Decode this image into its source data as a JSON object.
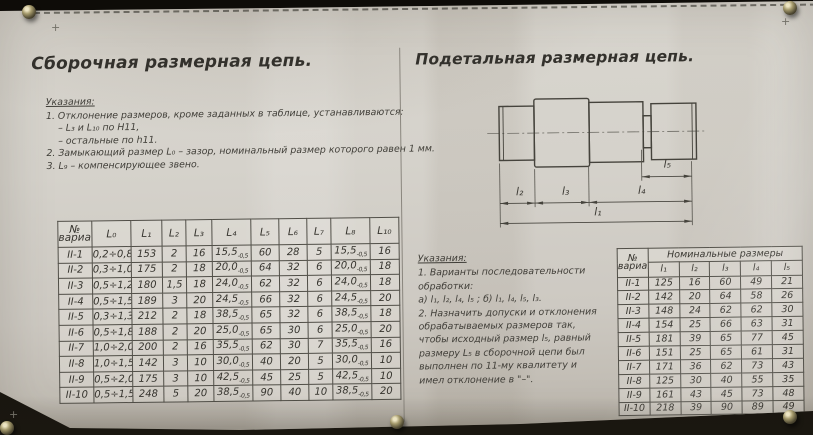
{
  "colors": {
    "paper": "#d6d2ca",
    "ink": "#3c3a35",
    "background": "#12100b",
    "table_line": "#504e47"
  },
  "left": {
    "title": "Сборочная размерная цепь.",
    "notes_heading": "Указания:",
    "notes": [
      "1. Отклонение размеров, кроме заданных в таблице, устанавливаются:",
      "    – L₃ и L₁₀ по H11,",
      "    – остальные по h11.",
      "2. Замыкающий размер L₀ – зазор, номинальный размер которого равен 1 мм.",
      "3. L₉ – компенсирующее звено."
    ],
    "table": {
      "headers": [
        "№ варианта",
        "L₀",
        "L₁",
        "L₂",
        "L₃",
        "L₄",
        "L₅",
        "L₆",
        "L₇",
        "L₈",
        "L₁₀"
      ],
      "rows": [
        [
          "II-1",
          "0,2÷0,8",
          "153",
          "2",
          "16",
          "15,5|-0,5",
          "60",
          "28",
          "5",
          "15,5|-0,5",
          "16"
        ],
        [
          "II-2",
          "0,3÷1,0",
          "175",
          "2",
          "18",
          "20,0|-0,5",
          "64",
          "32",
          "6",
          "20,0|-0,5",
          "18"
        ],
        [
          "II-3",
          "0,5÷1,2",
          "180",
          "1,5",
          "18",
          "24,0|-0,5",
          "62",
          "32",
          "6",
          "24,0|-0,5",
          "18"
        ],
        [
          "II-4",
          "0,5÷1,5",
          "189",
          "3",
          "20",
          "24,5|-0,5",
          "66",
          "32",
          "6",
          "24,5|-0,5",
          "20"
        ],
        [
          "II-5",
          "0,3÷1,3",
          "212",
          "2",
          "18",
          "38,5|-0,5",
          "65",
          "32",
          "6",
          "38,5|-0,5",
          "18"
        ],
        [
          "II-6",
          "0,5÷1,8",
          "188",
          "2",
          "20",
          "25,0|-0,5",
          "65",
          "30",
          "6",
          "25,0|-0,5",
          "20"
        ],
        [
          "II-7",
          "1,0÷2,0",
          "200",
          "2",
          "16",
          "35,5|-0,5",
          "62",
          "30",
          "7",
          "35,5|-0,5",
          "16"
        ],
        [
          "II-8",
          "1,0÷1,5",
          "142",
          "3",
          "10",
          "30,0|-0,5",
          "40",
          "20",
          "5",
          "30,0|-0,5",
          "10"
        ],
        [
          "II-9",
          "0,5÷2,0",
          "175",
          "3",
          "10",
          "42,5|-0,5",
          "45",
          "25",
          "5",
          "42,5|-0,5",
          "10"
        ],
        [
          "II-10",
          "0,5÷1,5",
          "248",
          "5",
          "20",
          "38,5|-0,5",
          "90",
          "40",
          "10",
          "38,5|-0,5",
          "20"
        ]
      ]
    }
  },
  "right": {
    "title": "Подетальная размерная цепь.",
    "drawing": {
      "labels": {
        "l1": "l₁",
        "l2": "l₂",
        "l3": "l₃",
        "l4": "l₄",
        "l5": "l₅"
      }
    },
    "notes_heading": "Указания:",
    "notes": [
      "1. Варианты последовательности",
      "обработки:",
      "а) l₁, l₂, l₄, l₅ ; б) l₁, l₄, l₅, l₃.",
      "2. Назначить допуски и отклонения",
      "обрабатываемых размеров так,",
      "чтобы исходный размер l₅, равный",
      "размеру L₅ в сборочной цепи был",
      "выполнен по 11-му квалитету и",
      "имел отклонение в \"–\"."
    ],
    "table": {
      "group_header": "Номинальные размеры",
      "headers": [
        "№ варианта",
        "l₁",
        "l₂",
        "l₃",
        "l₄",
        "l₅"
      ],
      "rows": [
        [
          "II-1",
          "125",
          "16",
          "60",
          "49",
          "21"
        ],
        [
          "II-2",
          "142",
          "20",
          "64",
          "58",
          "26"
        ],
        [
          "II-3",
          "148",
          "24",
          "62",
          "62",
          "30"
        ],
        [
          "II-4",
          "154",
          "25",
          "66",
          "63",
          "31"
        ],
        [
          "II-5",
          "181",
          "39",
          "65",
          "77",
          "45"
        ],
        [
          "II-6",
          "151",
          "25",
          "65",
          "61",
          "31"
        ],
        [
          "II-7",
          "171",
          "36",
          "62",
          "73",
          "43"
        ],
        [
          "II-8",
          "125",
          "30",
          "40",
          "55",
          "35"
        ],
        [
          "II-9",
          "161",
          "43",
          "45",
          "73",
          "48"
        ],
        [
          "II-10",
          "218",
          "39",
          "90",
          "89",
          "49"
        ]
      ]
    }
  }
}
